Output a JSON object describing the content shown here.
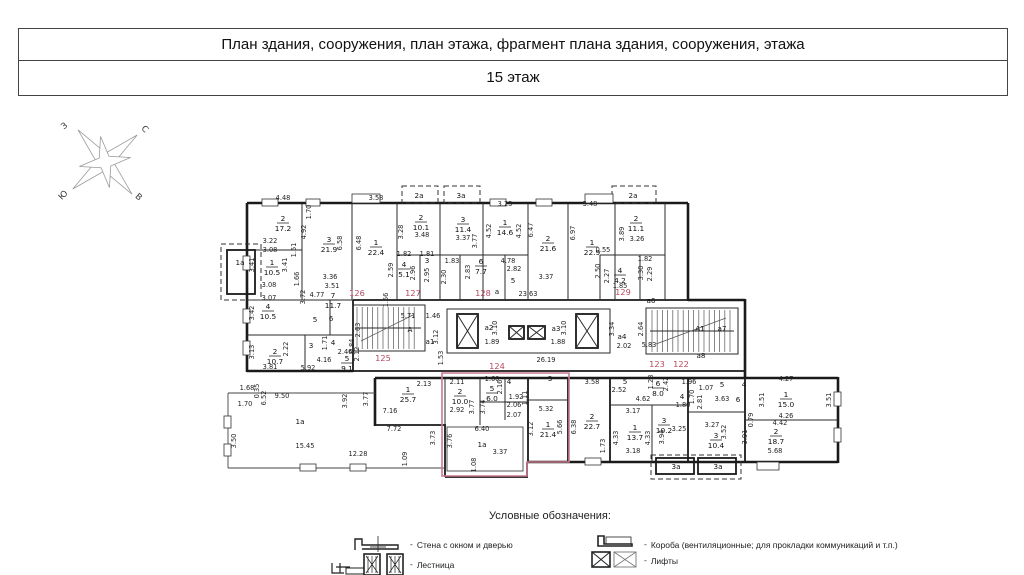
{
  "header": {
    "title": "План здания, сооружения, план этажа, фрагмент плана здания, сооружения, этажа",
    "floor": "15 этаж"
  },
  "compass": {
    "west": "З",
    "north": "С",
    "south": "Ю",
    "east": "В"
  },
  "plan": {
    "red_color": "#b4485f",
    "highlight_color": "#c9798f",
    "apartments": [
      {
        "t": "122",
        "x": 681,
        "y": 367
      },
      {
        "t": "123",
        "x": 657,
        "y": 367
      },
      {
        "t": "124",
        "x": 497,
        "y": 369
      },
      {
        "t": "125",
        "x": 383,
        "y": 361
      },
      {
        "t": "126",
        "x": 357,
        "y": 296
      },
      {
        "t": "127",
        "x": 413,
        "y": 296
      },
      {
        "t": "128",
        "x": 483,
        "y": 296
      },
      {
        "t": "129",
        "x": 623,
        "y": 295
      }
    ],
    "rooms": [
      {
        "n": "2",
        "a": "17.2",
        "x": 283,
        "y": 221
      },
      {
        "n": "1",
        "a": "10.5",
        "x": 272,
        "y": 265
      },
      {
        "n": "3",
        "a": "21.9",
        "x": 329,
        "y": 242
      },
      {
        "n": "1",
        "a": "22.4",
        "x": 376,
        "y": 245
      },
      {
        "n": "2",
        "a": "10.1",
        "x": 421,
        "y": 220
      },
      {
        "n": "3",
        "a": "11.4",
        "x": 463,
        "y": 222
      },
      {
        "n": "4",
        "a": "5.1",
        "x": 404,
        "y": 267
      },
      {
        "n": "1",
        "a": "14.6",
        "x": 505,
        "y": 225
      },
      {
        "n": "2",
        "a": "21.6",
        "x": 548,
        "y": 241
      },
      {
        "n": "1",
        "a": "22.9",
        "x": 592,
        "y": 245
      },
      {
        "n": "2",
        "a": "11.1",
        "x": 636,
        "y": 221
      },
      {
        "n": "4",
        "a": "4.2",
        "x": 620,
        "y": 273
      },
      {
        "n": "6",
        "a": "7.7",
        "x": 481,
        "y": 264
      },
      {
        "n": "4",
        "a": "10.5",
        "x": 268,
        "y": 309
      },
      {
        "n": "2",
        "a": "10.7",
        "x": 275,
        "y": 354
      },
      {
        "n": "7",
        "a": "11.7",
        "x": 333,
        "y": 298
      },
      {
        "n": "5",
        "a": "9.1",
        "x": 347,
        "y": 361
      },
      {
        "n": "1",
        "a": "25.7",
        "x": 408,
        "y": 392
      },
      {
        "n": "2",
        "a": "10.0",
        "x": 460,
        "y": 394
      },
      {
        "n": "5",
        "a": "6.0",
        "x": 492,
        "y": 391
      },
      {
        "n": "1",
        "a": "21.4",
        "x": 548,
        "y": 427
      },
      {
        "n": "2",
        "a": "22.7",
        "x": 592,
        "y": 419
      },
      {
        "n": "1",
        "a": "13.7",
        "x": 635,
        "y": 430
      },
      {
        "n": "3",
        "a": "10.2",
        "x": 664,
        "y": 423
      },
      {
        "n": "6",
        "a": "8.0",
        "x": 658,
        "y": 386
      },
      {
        "n": "3",
        "a": "10.4",
        "x": 716,
        "y": 438
      },
      {
        "n": "1",
        "a": "15.0",
        "x": 786,
        "y": 397
      },
      {
        "n": "2",
        "a": "18.7",
        "x": 776,
        "y": 434
      }
    ],
    "labels": [
      {
        "t": "а",
        "x": 497,
        "y": 294
      },
      {
        "t": "а1",
        "x": 430,
        "y": 344
      },
      {
        "t": "а2",
        "x": 489,
        "y": 330
      },
      {
        "t": "а3",
        "x": 556,
        "y": 331
      },
      {
        "t": "а4",
        "x": 622,
        "y": 339
      },
      {
        "t": "а6",
        "x": 651,
        "y": 303
      },
      {
        "t": "а7",
        "x": 722,
        "y": 331
      },
      {
        "t": "а8",
        "x": 701,
        "y": 358
      },
      {
        "t": "А",
        "x": 410,
        "y": 332
      },
      {
        "t": "А1",
        "x": 700,
        "y": 331
      },
      {
        "t": "1а",
        "x": 240,
        "y": 265
      },
      {
        "t": "2а",
        "x": 419,
        "y": 198
      },
      {
        "t": "3а",
        "x": 461,
        "y": 198
      },
      {
        "t": "2а",
        "x": 633,
        "y": 198
      },
      {
        "t": "1а",
        "x": 300,
        "y": 424
      },
      {
        "t": "1а",
        "x": 482,
        "y": 447
      },
      {
        "t": "3а",
        "x": 676,
        "y": 469
      },
      {
        "t": "3а",
        "x": 718,
        "y": 469
      },
      {
        "t": "5",
        "x": 315,
        "y": 322
      },
      {
        "t": "6",
        "x": 331,
        "y": 321
      },
      {
        "t": "3",
        "x": 311,
        "y": 348
      },
      {
        "t": "4",
        "x": 333,
        "y": 345
      },
      {
        "t": "3",
        "x": 427,
        "y": 263
      },
      {
        "t": "5",
        "x": 513,
        "y": 283
      },
      {
        "t": "4",
        "x": 509,
        "y": 384
      },
      {
        "t": "3",
        "x": 550,
        "y": 381
      },
      {
        "t": "5",
        "x": 625,
        "y": 384
      },
      {
        "t": "4",
        "x": 682,
        "y": 399
      },
      {
        "t": "5",
        "x": 722,
        "y": 387
      },
      {
        "t": "4",
        "x": 744,
        "y": 387
      },
      {
        "t": "6",
        "x": 738,
        "y": 402
      }
    ],
    "dims": [
      {
        "t": "4.48",
        "x": 283,
        "y": 200
      },
      {
        "t": "3.58",
        "x": 376,
        "y": 200
      },
      {
        "t": "3.23",
        "x": 505,
        "y": 206
      },
      {
        "t": "3.48",
        "x": 590,
        "y": 206
      },
      {
        "t": "1.70",
        "x": 311,
        "y": 212,
        "v": 1
      },
      {
        "t": "4.92",
        "x": 306,
        "y": 232,
        "v": 1
      },
      {
        "t": "6.58",
        "x": 342,
        "y": 243,
        "v": 1
      },
      {
        "t": "6.48",
        "x": 361,
        "y": 243,
        "v": 1
      },
      {
        "t": "3.48",
        "x": 422,
        "y": 237
      },
      {
        "t": "3.28",
        "x": 403,
        "y": 232,
        "v": 1
      },
      {
        "t": "3.37",
        "x": 463,
        "y": 240
      },
      {
        "t": "3.77",
        "x": 477,
        "y": 241,
        "v": 1
      },
      {
        "t": "4.52",
        "x": 491,
        "y": 231,
        "v": 1
      },
      {
        "t": "4.52",
        "x": 521,
        "y": 231,
        "v": 1
      },
      {
        "t": "6.47",
        "x": 533,
        "y": 230,
        "v": 1
      },
      {
        "t": "6.97",
        "x": 575,
        "y": 233,
        "v": 1
      },
      {
        "t": "3.89",
        "x": 624,
        "y": 234,
        "v": 1
      },
      {
        "t": "3.26",
        "x": 637,
        "y": 241
      },
      {
        "t": "0.55",
        "x": 603,
        "y": 252
      },
      {
        "t": "3.22",
        "x": 270,
        "y": 243
      },
      {
        "t": "3.08",
        "x": 270,
        "y": 252
      },
      {
        "t": "3.41",
        "x": 254,
        "y": 265,
        "v": 1
      },
      {
        "t": "3.41",
        "x": 287,
        "y": 265,
        "v": 1
      },
      {
        "t": "1.51",
        "x": 296,
        "y": 250,
        "v": 1
      },
      {
        "t": "1.66",
        "x": 299,
        "y": 279,
        "v": 1
      },
      {
        "t": "3.08",
        "x": 269,
        "y": 287
      },
      {
        "t": "3.07",
        "x": 269,
        "y": 300
      },
      {
        "t": "3.42",
        "x": 254,
        "y": 313,
        "v": 1
      },
      {
        "t": "3.72",
        "x": 305,
        "y": 297,
        "v": 1
      },
      {
        "t": "3.36",
        "x": 330,
        "y": 279
      },
      {
        "t": "3.51",
        "x": 332,
        "y": 288
      },
      {
        "t": "4.77",
        "x": 317,
        "y": 297
      },
      {
        "t": "1.56",
        "x": 388,
        "y": 300,
        "v": 1
      },
      {
        "t": "2.59",
        "x": 393,
        "y": 270,
        "v": 1
      },
      {
        "t": "1.82",
        "x": 404,
        "y": 256
      },
      {
        "t": "1.81",
        "x": 427,
        "y": 256
      },
      {
        "t": "2.96",
        "x": 415,
        "y": 273,
        "v": 1
      },
      {
        "t": "2.95",
        "x": 429,
        "y": 275,
        "v": 1
      },
      {
        "t": "1.83",
        "x": 452,
        "y": 263
      },
      {
        "t": "2.30",
        "x": 446,
        "y": 277,
        "v": 1
      },
      {
        "t": "2.83",
        "x": 470,
        "y": 272,
        "v": 1
      },
      {
        "t": "4.78",
        "x": 508,
        "y": 263
      },
      {
        "t": "2.82",
        "x": 514,
        "y": 271
      },
      {
        "t": "3.37",
        "x": 546,
        "y": 279
      },
      {
        "t": "2.50",
        "x": 600,
        "y": 271,
        "v": 1
      },
      {
        "t": "2.27",
        "x": 609,
        "y": 276,
        "v": 1
      },
      {
        "t": "1.85",
        "x": 620,
        "y": 288
      },
      {
        "t": "1.82",
        "x": 645,
        "y": 261
      },
      {
        "t": "3.30",
        "x": 643,
        "y": 273,
        "v": 1
      },
      {
        "t": "2.29",
        "x": 652,
        "y": 274,
        "v": 1
      },
      {
        "t": "23.63",
        "x": 528,
        "y": 296
      },
      {
        "t": "5.71",
        "x": 408,
        "y": 318
      },
      {
        "t": "1.46",
        "x": 433,
        "y": 318
      },
      {
        "t": "2.63",
        "x": 360,
        "y": 330,
        "v": 1
      },
      {
        "t": "3.12",
        "x": 438,
        "y": 337,
        "v": 1
      },
      {
        "t": "1.53",
        "x": 443,
        "y": 358,
        "v": 1
      },
      {
        "t": "0.84",
        "x": 354,
        "y": 346,
        "v": 1
      },
      {
        "t": "2.12",
        "x": 359,
        "y": 354,
        "v": 1
      },
      {
        "t": "3.10",
        "x": 497,
        "y": 328,
        "v": 1
      },
      {
        "t": "1.89",
        "x": 492,
        "y": 344
      },
      {
        "t": "3.10",
        "x": 566,
        "y": 328,
        "v": 1
      },
      {
        "t": "1.88",
        "x": 558,
        "y": 344
      },
      {
        "t": "3.34",
        "x": 614,
        "y": 329,
        "v": 1
      },
      {
        "t": "2.02",
        "x": 624,
        "y": 348
      },
      {
        "t": "2.64",
        "x": 643,
        "y": 329,
        "v": 1
      },
      {
        "t": "5.83",
        "x": 649,
        "y": 347
      },
      {
        "t": "26.19",
        "x": 546,
        "y": 362
      },
      {
        "t": "2.22",
        "x": 288,
        "y": 349,
        "v": 1
      },
      {
        "t": "3.13",
        "x": 254,
        "y": 352,
        "v": 1
      },
      {
        "t": "3.81",
        "x": 270,
        "y": 369
      },
      {
        "t": "1.71",
        "x": 327,
        "y": 343,
        "v": 1
      },
      {
        "t": "2.46",
        "x": 345,
        "y": 354
      },
      {
        "t": "4.16",
        "x": 324,
        "y": 362
      },
      {
        "t": "5.92",
        "x": 308,
        "y": 370
      },
      {
        "t": "1.68",
        "x": 247,
        "y": 390
      },
      {
        "t": "0.35",
        "x": 259,
        "y": 391,
        "v": 1
      },
      {
        "t": "1.70",
        "x": 245,
        "y": 406
      },
      {
        "t": "3.50",
        "x": 236,
        "y": 441,
        "v": 1
      },
      {
        "t": "9.50",
        "x": 282,
        "y": 398
      },
      {
        "t": "6.52",
        "x": 266,
        "y": 398,
        "v": 1
      },
      {
        "t": "3.92",
        "x": 347,
        "y": 401,
        "v": 1
      },
      {
        "t": "15.45",
        "x": 305,
        "y": 448
      },
      {
        "t": "12.28",
        "x": 358,
        "y": 456
      },
      {
        "t": "1.09",
        "x": 407,
        "y": 459,
        "v": 1
      },
      {
        "t": "3.77",
        "x": 368,
        "y": 399,
        "v": 1
      },
      {
        "t": "7.16",
        "x": 390,
        "y": 413
      },
      {
        "t": "7.72",
        "x": 394,
        "y": 431
      },
      {
        "t": "2.13",
        "x": 424,
        "y": 386
      },
      {
        "t": "2.11",
        "x": 457,
        "y": 384
      },
      {
        "t": "2.92",
        "x": 457,
        "y": 412
      },
      {
        "t": "3.77",
        "x": 474,
        "y": 407,
        "v": 1
      },
      {
        "t": "3.74",
        "x": 485,
        "y": 407,
        "v": 1
      },
      {
        "t": "1.60",
        "x": 492,
        "y": 381
      },
      {
        "t": "2.16",
        "x": 502,
        "y": 387,
        "v": 1
      },
      {
        "t": "1.92",
        "x": 516,
        "y": 399
      },
      {
        "t": "2.06",
        "x": 514,
        "y": 407
      },
      {
        "t": "2.07",
        "x": 514,
        "y": 417
      },
      {
        "t": "1.11",
        "x": 527,
        "y": 398,
        "v": 1
      },
      {
        "t": "5.32",
        "x": 546,
        "y": 411
      },
      {
        "t": "5.66",
        "x": 562,
        "y": 427,
        "v": 1
      },
      {
        "t": "3.12",
        "x": 533,
        "y": 429,
        "v": 1
      },
      {
        "t": "6.38",
        "x": 576,
        "y": 427,
        "v": 1
      },
      {
        "t": "3.73",
        "x": 435,
        "y": 438,
        "v": 1
      },
      {
        "t": "3.76",
        "x": 452,
        "y": 441,
        "v": 1
      },
      {
        "t": "6.40",
        "x": 482,
        "y": 431
      },
      {
        "t": "3.37",
        "x": 500,
        "y": 454
      },
      {
        "t": "1.08",
        "x": 476,
        "y": 465,
        "v": 1
      },
      {
        "t": "3.58",
        "x": 592,
        "y": 384
      },
      {
        "t": "2.52",
        "x": 619,
        "y": 392
      },
      {
        "t": "4.62",
        "x": 643,
        "y": 401
      },
      {
        "t": "1.28",
        "x": 653,
        "y": 382,
        "v": 1
      },
      {
        "t": "2.42",
        "x": 668,
        "y": 384,
        "v": 1
      },
      {
        "t": "3.17",
        "x": 633,
        "y": 413
      },
      {
        "t": "4.33",
        "x": 618,
        "y": 438,
        "v": 1
      },
      {
        "t": "4.33",
        "x": 650,
        "y": 438,
        "v": 1
      },
      {
        "t": "3.18",
        "x": 633,
        "y": 453
      },
      {
        "t": "1.73",
        "x": 605,
        "y": 446,
        "v": 1
      },
      {
        "t": "3.94",
        "x": 664,
        "y": 437,
        "v": 1
      },
      {
        "t": "3.25",
        "x": 679,
        "y": 431
      },
      {
        "t": "1.80",
        "x": 683,
        "y": 407
      },
      {
        "t": "1.70",
        "x": 694,
        "y": 397,
        "v": 1
      },
      {
        "t": "1.96",
        "x": 689,
        "y": 384
      },
      {
        "t": "1.07",
        "x": 706,
        "y": 390
      },
      {
        "t": "3.63",
        "x": 722,
        "y": 401
      },
      {
        "t": "2.81",
        "x": 702,
        "y": 402,
        "v": 1
      },
      {
        "t": "3.27",
        "x": 712,
        "y": 427
      },
      {
        "t": "3.52",
        "x": 726,
        "y": 432,
        "v": 1
      },
      {
        "t": "3.91",
        "x": 747,
        "y": 437,
        "v": 1
      },
      {
        "t": "4.27",
        "x": 786,
        "y": 381
      },
      {
        "t": "3.51",
        "x": 764,
        "y": 400,
        "v": 1
      },
      {
        "t": "3.51",
        "x": 831,
        "y": 400,
        "v": 1
      },
      {
        "t": "4.26",
        "x": 786,
        "y": 418
      },
      {
        "t": "4.42",
        "x": 780,
        "y": 425
      },
      {
        "t": "5.68",
        "x": 775,
        "y": 453
      },
      {
        "t": "0.79",
        "x": 753,
        "y": 420,
        "v": 1
      }
    ]
  },
  "legend": {
    "title": "Условные обозначения:",
    "dash": "-",
    "left": [
      {
        "label": "Стена с окном и дверью"
      },
      {
        "label": "Лестница"
      }
    ],
    "right": [
      {
        "label": "Короба  (вентиляционные; для прокладки коммуникаций и т.п.)"
      },
      {
        "label": "Лифты"
      }
    ]
  }
}
